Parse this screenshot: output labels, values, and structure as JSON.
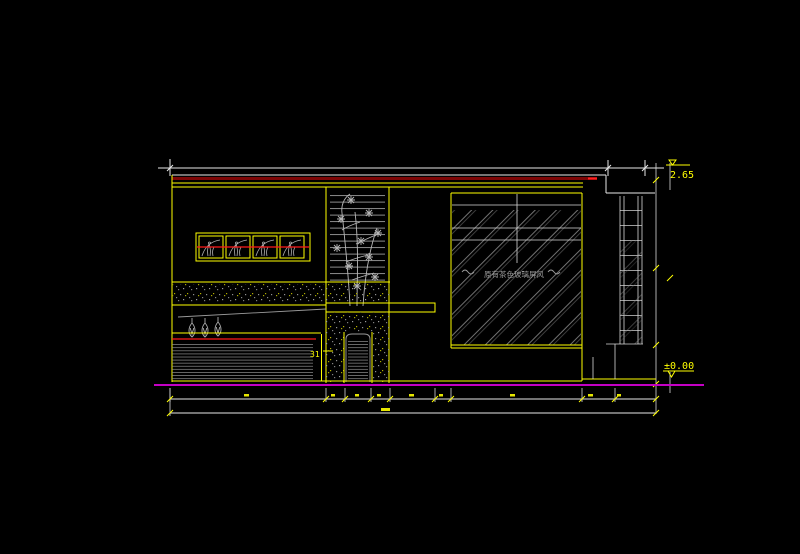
{
  "drawing": {
    "type": "cad-interior-elevation",
    "levels": {
      "top": "2.65",
      "bottom": "±0.00"
    },
    "labels": {
      "section_mark": "31",
      "glass_note": "原有茶色玻璃屏风"
    },
    "colors": {
      "background": "#000000",
      "outline": "#e8e8e8",
      "detail_gray": "#9a9a9a",
      "highlight_yellow": "#ffff00",
      "red_line": "#ff1a1a",
      "dark_red_band": "#7d0505",
      "floor_magenta": "#c400c4"
    }
  }
}
